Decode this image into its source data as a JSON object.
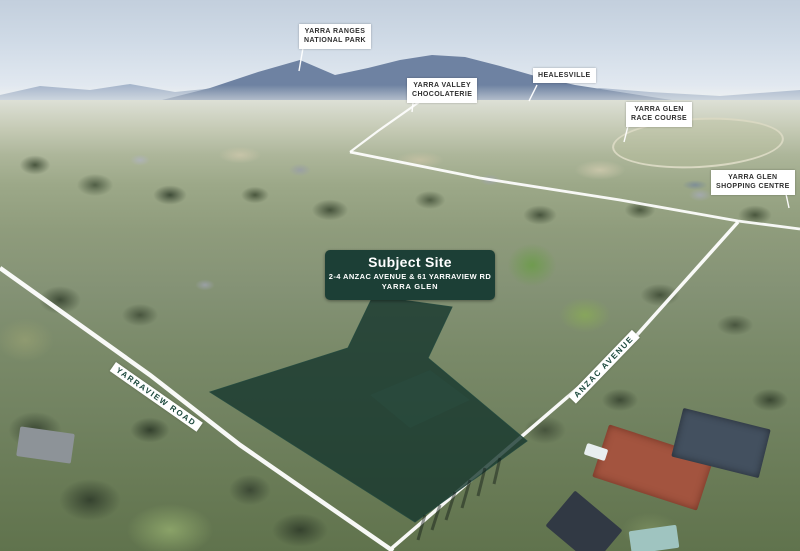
{
  "window": {
    "width": 800,
    "height": 551
  },
  "scene": {
    "description": "Annotated aerial location photo of Yarra Glen development site",
    "location_labels": [
      {
        "id": "yarra-ranges-national-park",
        "text": "YARRA RANGES\nNATIONAL PARK"
      },
      {
        "id": "yarra-valley-chocolaterie",
        "text": "YARRA VALLEY\nCHOCOLATERIE"
      },
      {
        "id": "healesville",
        "text": "HEALESVILLE"
      },
      {
        "id": "yarra-glen-race-course",
        "text": "YARRA GLEN\nRACE COURSE"
      },
      {
        "id": "yarra-glen-shopping-centre",
        "text": "YARRA GLEN\nSHOPPING CENTRE"
      }
    ],
    "subject_site": {
      "title": "Subject Site",
      "address": "2-4 ANZAC AVENUE & 61 YARRAVIEW RD",
      "locality": "YARRA GLEN"
    },
    "road_labels": {
      "yarraview": "YARRAVIEW ROAD",
      "anzac": "ANZAC AVENUE"
    },
    "colors": {
      "site_overlay_fill": "#15362d",
      "subject_box_bg": "#1c3f36",
      "label_bg": "#ffffff",
      "label_text": "#2f2f2f",
      "road_label_text": "#1d4a3e",
      "road_line": "#ffffff"
    }
  }
}
